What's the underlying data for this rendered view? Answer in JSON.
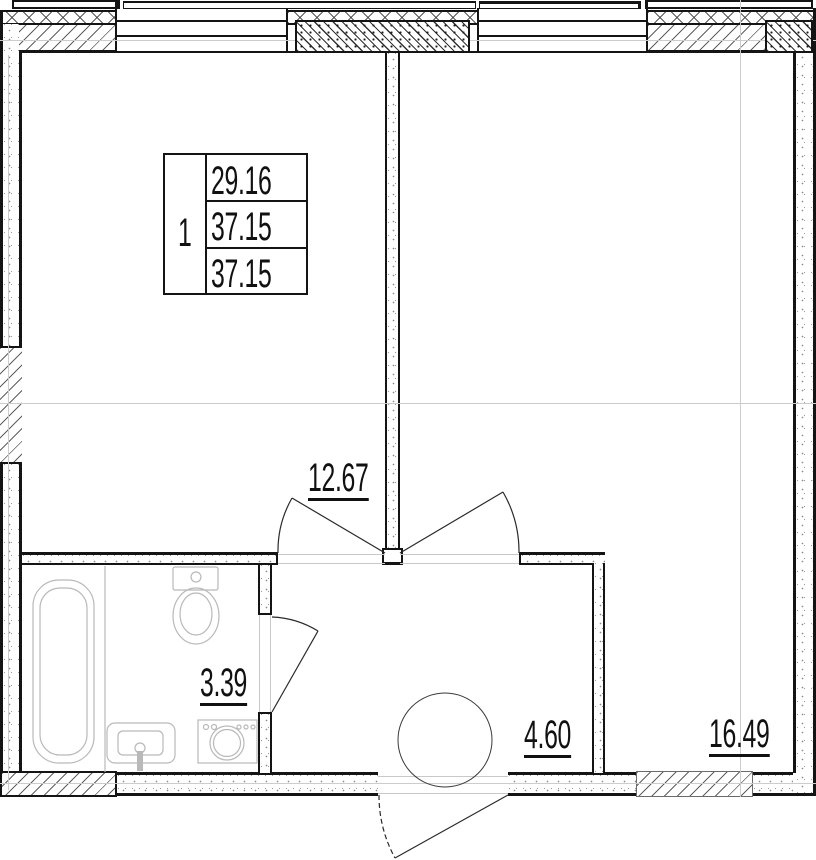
{
  "info_table": {
    "unit_number": "1",
    "values": [
      "29.16",
      "37.15",
      "37.15"
    ]
  },
  "rooms": {
    "living_room_area": "12.67",
    "bathroom_area": "3.39",
    "hallway_area": "4.60",
    "bedroom_area": "16.49"
  },
  "icons": {
    "fixtures": [
      "bathtub-icon",
      "toilet-icon",
      "sink-icon",
      "washing-machine-icon",
      "water-heater-icon"
    ]
  },
  "colors": {
    "wall_line": "#141414",
    "fixture_line": "#b9b9b9",
    "axis_line": "#cccccc",
    "text": "#111111"
  }
}
